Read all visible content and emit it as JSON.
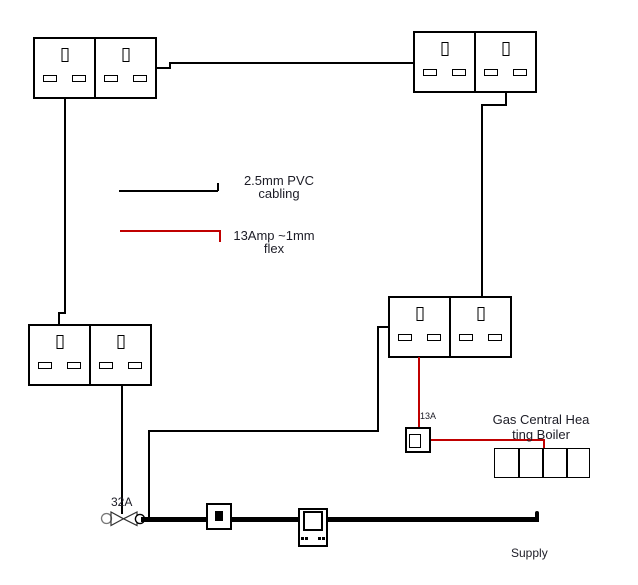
{
  "legend": {
    "cabling": {
      "line1": "2.5mm PVC",
      "line2": "cabling",
      "color": "#000000"
    },
    "flex": {
      "line1": "13Amp ~1mm",
      "line2": "flex",
      "color": "#c00000"
    }
  },
  "labels": {
    "breaker_rating": "32A",
    "spur_fuse_rating": "13A",
    "supply": "Supply"
  },
  "boiler": {
    "line1": "Gas Central Hea",
    "line2": "ting Boiler"
  },
  "colors": {
    "cable": "#000000",
    "flex": "#c00000",
    "text": "#1c1c26"
  }
}
